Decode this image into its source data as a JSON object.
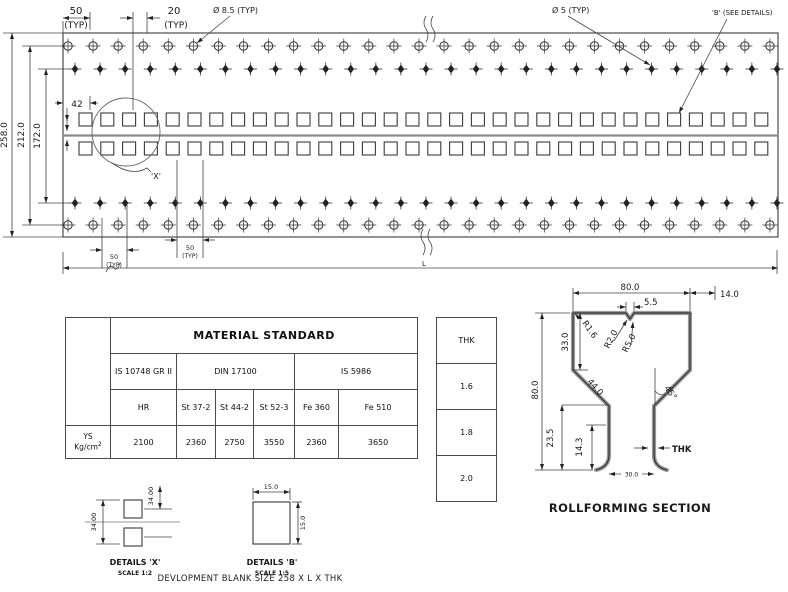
{
  "panel": {
    "dims": {
      "d50_top": {
        "v": "50",
        "t": "(TYP)"
      },
      "d20": {
        "v": "20",
        "t": "(TYP)"
      },
      "dia_large": "Ø 8.5 (TYP)",
      "dia_small": "Ø 5 (TYP)",
      "b_ref": "'B' (SEE DETAILS)",
      "h258": "258.0",
      "h212": "212.0",
      "h172": "172.0",
      "d42": "42",
      "x_ref": "'X'",
      "d50_b1": {
        "v": "50",
        "t": "(TYP)"
      },
      "d50_b2": {
        "v": "50",
        "t": "(TYP)"
      },
      "length": "L"
    },
    "pattern": {
      "circle_rows": [
        {
          "y": 46,
          "x0": 68,
          "dx": 25.07,
          "n": 29
        },
        {
          "y": 225,
          "x0": 68,
          "dx": 25.07,
          "n": 29
        }
      ],
      "diamond_rows": [
        {
          "y": 69,
          "x0": 75,
          "dx": 25.07,
          "n": 29
        },
        {
          "y": 203,
          "x0": 75,
          "dx": 25.07,
          "n": 29
        }
      ],
      "square_rows": [
        {
          "y": 113,
          "x0": 79,
          "dx": 21.8,
          "n": 32,
          "s": 13
        },
        {
          "y": 142,
          "x0": 79,
          "dx": 21.8,
          "n": 32,
          "s": 13
        }
      ]
    }
  },
  "material_table": {
    "title": "MATERIAL STANDARD",
    "standards": [
      "IS 10748 GR II",
      "DIN 17100",
      "IS 5986"
    ],
    "grades": [
      "HR",
      "St 37-2",
      "St 44-2",
      "St 52-3",
      "Fe 360",
      "Fe 510"
    ],
    "row_header": {
      "line1": "YS",
      "line2": "Kg/cm",
      "sup": "2"
    },
    "values": [
      "2100",
      "2360",
      "2750",
      "3550",
      "2360",
      "3650"
    ]
  },
  "thk_table": {
    "header": "THK",
    "values": [
      "1.6",
      "1.8",
      "2.0"
    ]
  },
  "section": {
    "title": "ROLLFORMING SECTION",
    "dims": {
      "top_width": "80.0",
      "notch": "5.5",
      "offset": "14.0",
      "r_corner": "R1.6",
      "r_notch": "R2.0",
      "r_notch2": "R5.0",
      "upper_wall": "33.0",
      "height": "80.0",
      "diag": "44.0",
      "angle": "45°",
      "lower": "23.5",
      "foot": "14.3",
      "thk": "THK",
      "bottom_width": "30.0"
    }
  },
  "details_x": {
    "title": "DETAILS 'X'",
    "scale": "SCALE 1:2",
    "dim1": "34.00",
    "dim2": "34.00"
  },
  "details_b": {
    "title": "DETAILS 'B'",
    "scale": "SCALE 1:5",
    "dim_w": "15.0",
    "dim_h": "15.0"
  },
  "note": {
    "text": "DEVLOPMENT BLANK SIZE 258 X L X THK"
  }
}
